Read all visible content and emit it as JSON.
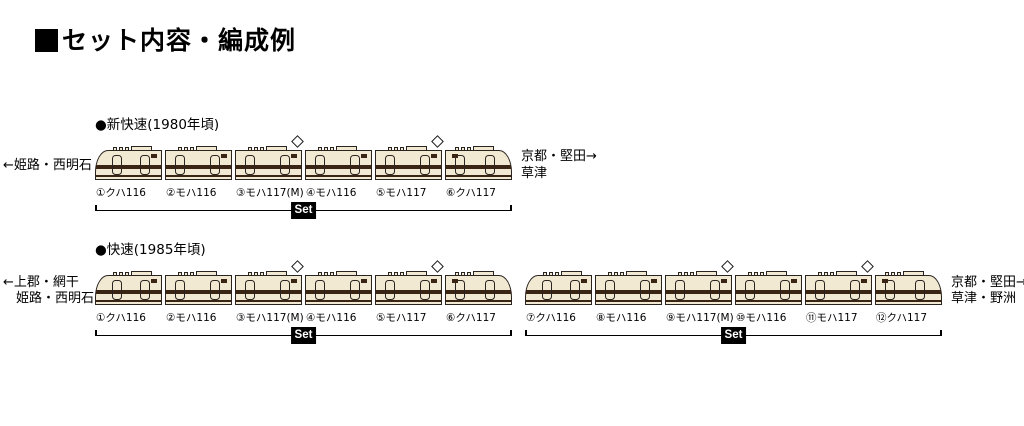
{
  "page": {
    "title": "セット内容・編成例"
  },
  "colors": {
    "car_body": "#F2E9D2",
    "car_outline": "#2A2420",
    "car_stripe": "#3A2414",
    "set_badge_bg": "#000000",
    "set_badge_text": "#FFFFFF"
  },
  "formations": [
    {
      "name": "●新快速(1980年頃)",
      "left_lines": [
        "←姫路・西明石"
      ],
      "right_lines": [
        "京都・堅田→",
        "草津"
      ],
      "cars": [
        {
          "label": "①クハ116",
          "type": "cab-left",
          "pantograph": false
        },
        {
          "label": "②モハ116",
          "type": "middle",
          "pantograph": false
        },
        {
          "label": "③モハ117(M)",
          "type": "middle",
          "pantograph": true
        },
        {
          "label": "④モハ116",
          "type": "middle",
          "pantograph": false
        },
        {
          "label": "⑤モハ117",
          "type": "middle",
          "pantograph": true
        },
        {
          "label": "⑥クハ117",
          "type": "cab-right",
          "pantograph": false
        }
      ],
      "sets": [
        {
          "from": 0,
          "to": 5,
          "label": "Set"
        }
      ]
    },
    {
      "name": "●快速(1985年頃)",
      "left_lines": [
        "←上郡・網干",
        "姫路・西明石"
      ],
      "right_lines": [
        "京都・堅田→",
        "草津・野洲"
      ],
      "cars": [
        {
          "label": "①クハ116",
          "type": "cab-left",
          "pantograph": false
        },
        {
          "label": "②モハ116",
          "type": "middle",
          "pantograph": false
        },
        {
          "label": "③モハ117(M)",
          "type": "middle",
          "pantograph": true
        },
        {
          "label": "④モハ116",
          "type": "middle",
          "pantograph": false
        },
        {
          "label": "⑤モハ117",
          "type": "middle",
          "pantograph": true
        },
        {
          "label": "⑥クハ117",
          "type": "cab-right",
          "pantograph": false
        },
        {
          "label": "⑦クハ116",
          "type": "cab-left",
          "pantograph": false
        },
        {
          "label": "⑧モハ116",
          "type": "middle",
          "pantograph": false
        },
        {
          "label": "⑨モハ117(M)",
          "type": "middle",
          "pantograph": true
        },
        {
          "label": "⑩モハ116",
          "type": "middle",
          "pantograph": false
        },
        {
          "label": "⑪モハ117",
          "type": "middle",
          "pantograph": true
        },
        {
          "label": "⑫クハ117",
          "type": "cab-right",
          "pantograph": false
        }
      ],
      "sets": [
        {
          "from": 0,
          "to": 5,
          "label": "Set"
        },
        {
          "from": 6,
          "to": 11,
          "label": "Set"
        }
      ]
    }
  ]
}
